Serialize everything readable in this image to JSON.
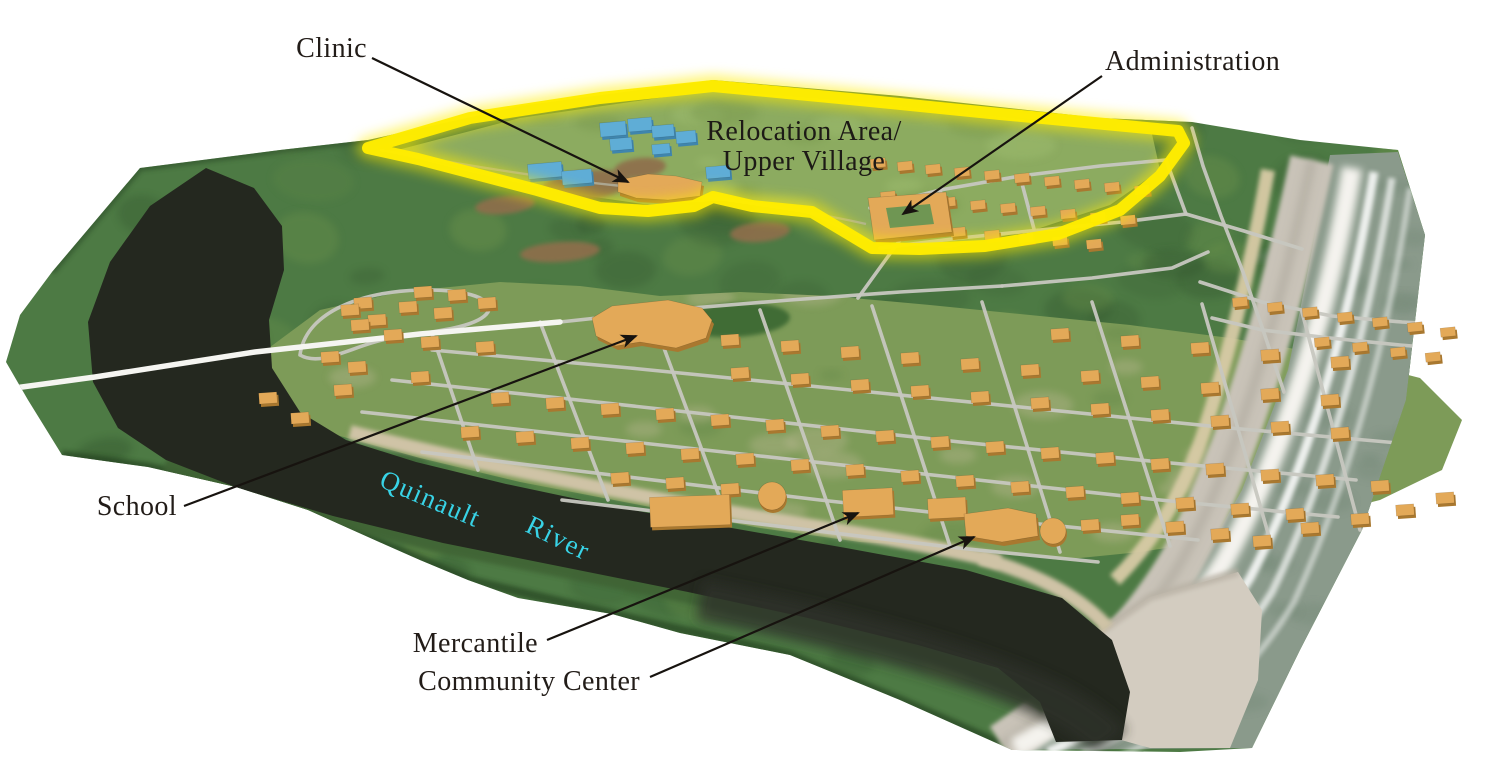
{
  "figure": {
    "description": "Oblique 3D aerial map of a coastal village on the Quinault River with a highlighted relocation area"
  },
  "annotations": [
    {
      "id": "clinic",
      "text": "Clinic",
      "tx": 367,
      "ty": 57,
      "anchor": "end",
      "line": [
        372,
        58,
        628,
        182
      ]
    },
    {
      "id": "administration",
      "text": "Administration",
      "tx": 1105,
      "ty": 70,
      "anchor": "start",
      "line": [
        1102,
        76,
        903,
        214
      ]
    },
    {
      "id": "school",
      "text": "School",
      "tx": 177,
      "ty": 515,
      "anchor": "end",
      "line": [
        184,
        506,
        636,
        336
      ]
    },
    {
      "id": "mercantile",
      "text": "Mercantile",
      "tx": 538,
      "ty": 652,
      "anchor": "end",
      "line": [
        547,
        640,
        858,
        513
      ]
    },
    {
      "id": "community-center",
      "text": "Community Center",
      "tx": 640,
      "ty": 690,
      "anchor": "end",
      "line": [
        650,
        677,
        974,
        537
      ]
    }
  ],
  "region": {
    "line1": "Relocation Area/",
    "line2": "Upper Village",
    "x": 804,
    "y1": 140,
    "y2": 170,
    "outline_color": "#ffec00"
  },
  "river_label": {
    "word1": "Quinault",
    "w1x": 378,
    "w1y": 486,
    "w1rot": 23,
    "word2": "River",
    "w2x": 524,
    "w2y": 531,
    "w2rot": 26,
    "color": "#38d3e6"
  },
  "colors": {
    "ink": "#221c18",
    "leader": "#17130f",
    "terrain": "#4d7a44",
    "forest_dark": "#2e5029",
    "forest_light": "#73984e",
    "upper_clearing": "#8cab60",
    "village_clearing": "#7d9b58",
    "river": "#24281f",
    "river_mouth": "#2e322a",
    "ocean": "#8a9a8b",
    "surf": "#f4f3ee",
    "beach": "#c9c3b8",
    "spit_sand": "#d3ccc0",
    "cliff": "#d8cba6",
    "road": "#c7c7c0",
    "road_white": "#f5f5f1",
    "house_top": "#e3a958",
    "house_side": "#a9782f",
    "blue_top": "#5fadd6",
    "blue_side": "#3f85ad",
    "sand_bank": "#cfc3a6",
    "dirt": "#8f6e4c",
    "field": "#3f6c36",
    "outline_yellow": "#ffec00"
  },
  "geometry": {
    "terrain": "M52,272 L140,168 L280,150 L368,140 L520,106 L713,80 L900,96 L1100,118 L1192,122 L1300,140 L1398,150 L1425,235 L1406,400 L1362,530 L1300,650 L1252,748 L1180,752 L1012,750 L900,700 L790,655 L680,633 L612,614 L518,598 L468,580 L420,560 L386,545 L308,510 L236,487 L148,467 L62,455 L28,400 L6,362 L20,315 Z",
    "river": "M206,168 L254,188 L282,226 L284,270 L269,320 L272,368 L300,412 L346,440 L416,462 L506,484 L610,506 L726,527 L846,548 L966,570 L1062,598 L1112,640 L1130,692 L1122,740 L1056,742 L1040,702 L998,668 L918,645 L808,618 L688,592 L563,567 L443,543 L333,516 L238,488 L166,460 L118,428 L93,382 L88,322 L110,262 L150,206 Z",
    "village": "M250,362 L320,310 L400,292 L500,282 L580,286 L660,296 L740,292 L830,296 L930,305 L1030,315 L1130,325 L1230,338 L1330,355 L1420,378 L1462,420 L1442,470 L1380,500 L1300,520 L1220,540 L1140,552 L1060,560 L960,548 L860,542 L760,528 L640,505 L520,482 L420,458 L340,436 L285,412 L258,385 Z",
    "upper": "M390,152 L520,118 L713,90 L860,102 L1010,118 L1152,134 L1160,170 L1110,205 L1040,228 L950,248 L870,242 L800,210 L730,200 L650,205 L560,192 L470,172 Z",
    "outline": "M368,148 L470,118 L600,98 L713,86 L850,99 L1000,114 L1105,124 L1178,131 L1184,143 L1160,176 L1120,210 L1058,234 L985,246 L920,249 L872,248 L812,212 L752,206 L713,197 L694,206 L648,211 L600,208 L537,190 L468,172 L418,159 Z",
    "ocean": "M1330,155 L1398,152 L1425,235 L1406,400 L1362,530 L1300,650 L1252,748 L1012,750 L1060,718 L1110,688 L1180,600 L1242,490 L1288,370 L1312,250 Z",
    "beach": "M1312,160 C1282,300 1242,450 1182,560 C1132,645 1062,705 1002,745",
    "cliff": "M1268,170 C1252,260 1232,345 1203,435 C1180,500 1150,545 1115,580",
    "surf": "M1352,168 C1330,300 1290,440 1225,560 C1170,650 1090,710 1015,748",
    "waves": [
      "M1374,172 C1352,305 1314,455 1250,578 C1198,662 1118,722 1048,752",
      "M1392,178 C1370,315 1334,465 1272,592 C1222,672 1152,726 1082,754",
      "M1410,188 C1390,325 1354,472 1294,602 C1247,682 1182,730 1122,755"
    ],
    "spit": "M1238,572 L1150,597 L1085,642 L1052,690 L1078,728 L1150,748 L1230,748 L1258,680 L1262,610 Z",
    "bank_veg": "M166,462 C240,492 340,520 445,545 C570,570 700,596 810,620 C920,646 1000,672 1048,706",
    "bank_sand": [
      "M350,432 C470,462 640,498 800,524 C900,540 960,552 1000,562",
      "M980,558 C1030,572 1078,594 1108,628"
    ],
    "white_road": "M0,390 L95,377 L255,352 L420,334 L560,322",
    "roads": [
      "M560,322 L680,309 L790,300 L900,292 L1002,286",
      "M1002,286 L1092,278 L1172,268 L1208,252",
      "M858,298 L884,262 L900,240 L916,222",
      "M870,208 L940,190 L1020,176 L1100,166 L1166,160",
      "M880,248 L960,238 L1040,230 L1122,222 L1186,214",
      "M1166,160 L1186,214",
      "M1020,176 L1034,229",
      "M940,190 L953,237",
      "M1186,214 L1244,231 L1302,249",
      "M1200,282 L1262,302 L1332,316 L1402,322 L1456,325",
      "M1456,325 L1460,350 L1400,345 L1330,338 L1262,330 L1212,318",
      "M1192,128 L1203,166 L1221,216 L1243,272 L1263,330 L1284,392",
      "M392,380 L560,398 L760,420 L960,442 L1160,462 L1356,480",
      "M362,412 L560,434 L760,456 L960,478 L1160,500 L1338,517",
      "M422,452 L620,476 L820,500 L1020,522 L1198,540",
      "M562,500 L760,524 L958,548 L1098,562",
      "M432,350 L630,368 L830,388 L1030,408 L1230,428 L1398,443",
      "M432,334 L478,470",
      "M540,322 L608,500",
      "M652,316 L728,520",
      "M760,310 L840,540",
      "M872,306 L950,546",
      "M982,302 L1060,552",
      "M1092,302 L1170,546",
      "M1202,304 L1270,540",
      "M1302,312 L1360,530",
      "M300,355 C305,315 355,292 420,290 C470,289 495,300 488,312 C478,328 430,332 392,338 C355,344 322,368 300,355"
    ],
    "trails": [
      "M380,150 C460,164 540,178 622,186",
      "M705,197 C770,206 822,214 866,224"
    ],
    "dirt": [
      [
        585,
        186,
        46,
        15,
        -8
      ],
      [
        640,
        168,
        26,
        10,
        -6
      ],
      [
        760,
        232,
        30,
        10,
        -5
      ],
      [
        560,
        252,
        40,
        10,
        -4
      ],
      [
        505,
        205,
        30,
        9,
        -6
      ]
    ],
    "field": [
      735,
      320,
      55,
      17,
      -3
    ]
  },
  "buildings": {
    "houses_low": [
      [
        423,
        292
      ],
      [
        457,
        295
      ],
      [
        487,
        303
      ],
      [
        443,
        313
      ],
      [
        408,
        307
      ],
      [
        363,
        303
      ],
      [
        350,
        310
      ],
      [
        377,
        320
      ],
      [
        360,
        325
      ],
      [
        393,
        335
      ],
      [
        330,
        357
      ],
      [
        357,
        367
      ],
      [
        420,
        377
      ],
      [
        343,
        390
      ],
      [
        300,
        418
      ],
      [
        268,
        398
      ],
      [
        1060,
        334
      ],
      [
        1130,
        341
      ],
      [
        1200,
        348
      ],
      [
        1270,
        355
      ],
      [
        1340,
        362
      ],
      [
        730,
        340
      ],
      [
        790,
        346
      ],
      [
        850,
        352
      ],
      [
        910,
        358
      ],
      [
        970,
        364
      ],
      [
        1030,
        370
      ],
      [
        1090,
        376
      ],
      [
        1150,
        382
      ],
      [
        1210,
        388
      ],
      [
        1270,
        394
      ],
      [
        1330,
        400
      ],
      [
        430,
        342
      ],
      [
        485,
        347
      ],
      [
        740,
        373
      ],
      [
        800,
        379
      ],
      [
        860,
        385
      ],
      [
        920,
        391
      ],
      [
        980,
        397
      ],
      [
        1040,
        403
      ],
      [
        1100,
        409
      ],
      [
        1160,
        415
      ],
      [
        1220,
        421
      ],
      [
        1280,
        427
      ],
      [
        1340,
        433
      ],
      [
        500,
        398
      ],
      [
        555,
        403
      ],
      [
        610,
        409
      ],
      [
        665,
        414
      ],
      [
        720,
        420
      ],
      [
        775,
        425
      ],
      [
        830,
        431
      ],
      [
        885,
        436
      ],
      [
        940,
        442
      ],
      [
        995,
        447
      ],
      [
        1050,
        453
      ],
      [
        1105,
        458
      ],
      [
        1160,
        464
      ],
      [
        1215,
        469
      ],
      [
        1270,
        475
      ],
      [
        1325,
        480
      ],
      [
        1380,
        486
      ],
      [
        470,
        432
      ],
      [
        525,
        437
      ],
      [
        580,
        443
      ],
      [
        635,
        448
      ],
      [
        690,
        454
      ],
      [
        745,
        459
      ],
      [
        800,
        465
      ],
      [
        855,
        470
      ],
      [
        910,
        476
      ],
      [
        965,
        481
      ],
      [
        1020,
        487
      ],
      [
        1075,
        492
      ],
      [
        1130,
        498
      ],
      [
        1185,
        503
      ],
      [
        1240,
        509
      ],
      [
        1295,
        514
      ],
      [
        620,
        478
      ],
      [
        675,
        483
      ],
      [
        730,
        489
      ],
      [
        950,
        511
      ],
      [
        1090,
        525
      ],
      [
        1310,
        528
      ],
      [
        1360,
        519
      ],
      [
        1405,
        510
      ],
      [
        1445,
        498
      ],
      [
        1130,
        520
      ],
      [
        1175,
        527
      ],
      [
        1220,
        534
      ],
      [
        1262,
        541
      ]
    ],
    "houses_up": [
      [
        878,
        163
      ],
      [
        905,
        166
      ],
      [
        933,
        169
      ],
      [
        962,
        172
      ],
      [
        992,
        175
      ],
      [
        1022,
        178
      ],
      [
        1052,
        181
      ],
      [
        1082,
        184
      ],
      [
        1112,
        187
      ],
      [
        1142,
        190
      ],
      [
        888,
        196
      ],
      [
        918,
        199
      ],
      [
        948,
        202
      ],
      [
        978,
        205
      ],
      [
        1008,
        208
      ],
      [
        1038,
        211
      ],
      [
        1068,
        214
      ],
      [
        1098,
        217
      ],
      [
        1128,
        220
      ],
      [
        958,
        232
      ],
      [
        992,
        235
      ],
      [
        1026,
        238
      ],
      [
        1060,
        241
      ],
      [
        1094,
        244
      ],
      [
        1240,
        302
      ],
      [
        1275,
        307
      ],
      [
        1310,
        312
      ],
      [
        1345,
        317
      ],
      [
        1380,
        322
      ],
      [
        1415,
        327
      ],
      [
        1448,
        332
      ],
      [
        1322,
        342
      ],
      [
        1360,
        347
      ],
      [
        1398,
        352
      ],
      [
        1433,
        357
      ]
    ],
    "blue": [
      [
        600,
        122,
        26,
        14
      ],
      [
        628,
        118,
        24,
        13
      ],
      [
        652,
        125,
        22,
        12
      ],
      [
        676,
        131,
        20,
        12
      ],
      [
        610,
        138,
        22,
        12
      ],
      [
        652,
        144,
        18,
        10
      ],
      [
        528,
        163,
        34,
        15
      ],
      [
        562,
        170,
        30,
        14
      ],
      [
        706,
        166,
        24,
        12
      ]
    ],
    "school_path": "M592,318 L612,306 L668,300 L702,308 L712,320 L706,338 L676,348 L640,342 L616,346 L596,336 Z",
    "clinic_path": "M618,180 L648,174 L676,176 L702,182 L700,196 L668,200 L636,198 L618,192 Z",
    "admin_outer": "M868,198 L946,192 L952,232 L874,240 Z",
    "admin_inner": "M886,208 L930,204 L934,224 L890,228 Z",
    "mercantile": [
      843,
      489,
      50,
      27,
      -3
    ],
    "gym": [
      650,
      496,
      80,
      30,
      -2
    ],
    "mid_store": [
      928,
      498,
      38,
      20,
      -3
    ],
    "community_path": "M964,514 L1008,508 L1036,514 L1038,536 L1002,542 L966,536 Z",
    "tanks": [
      [
        772,
        496,
        14
      ],
      [
        1053,
        531,
        13
      ]
    ]
  }
}
